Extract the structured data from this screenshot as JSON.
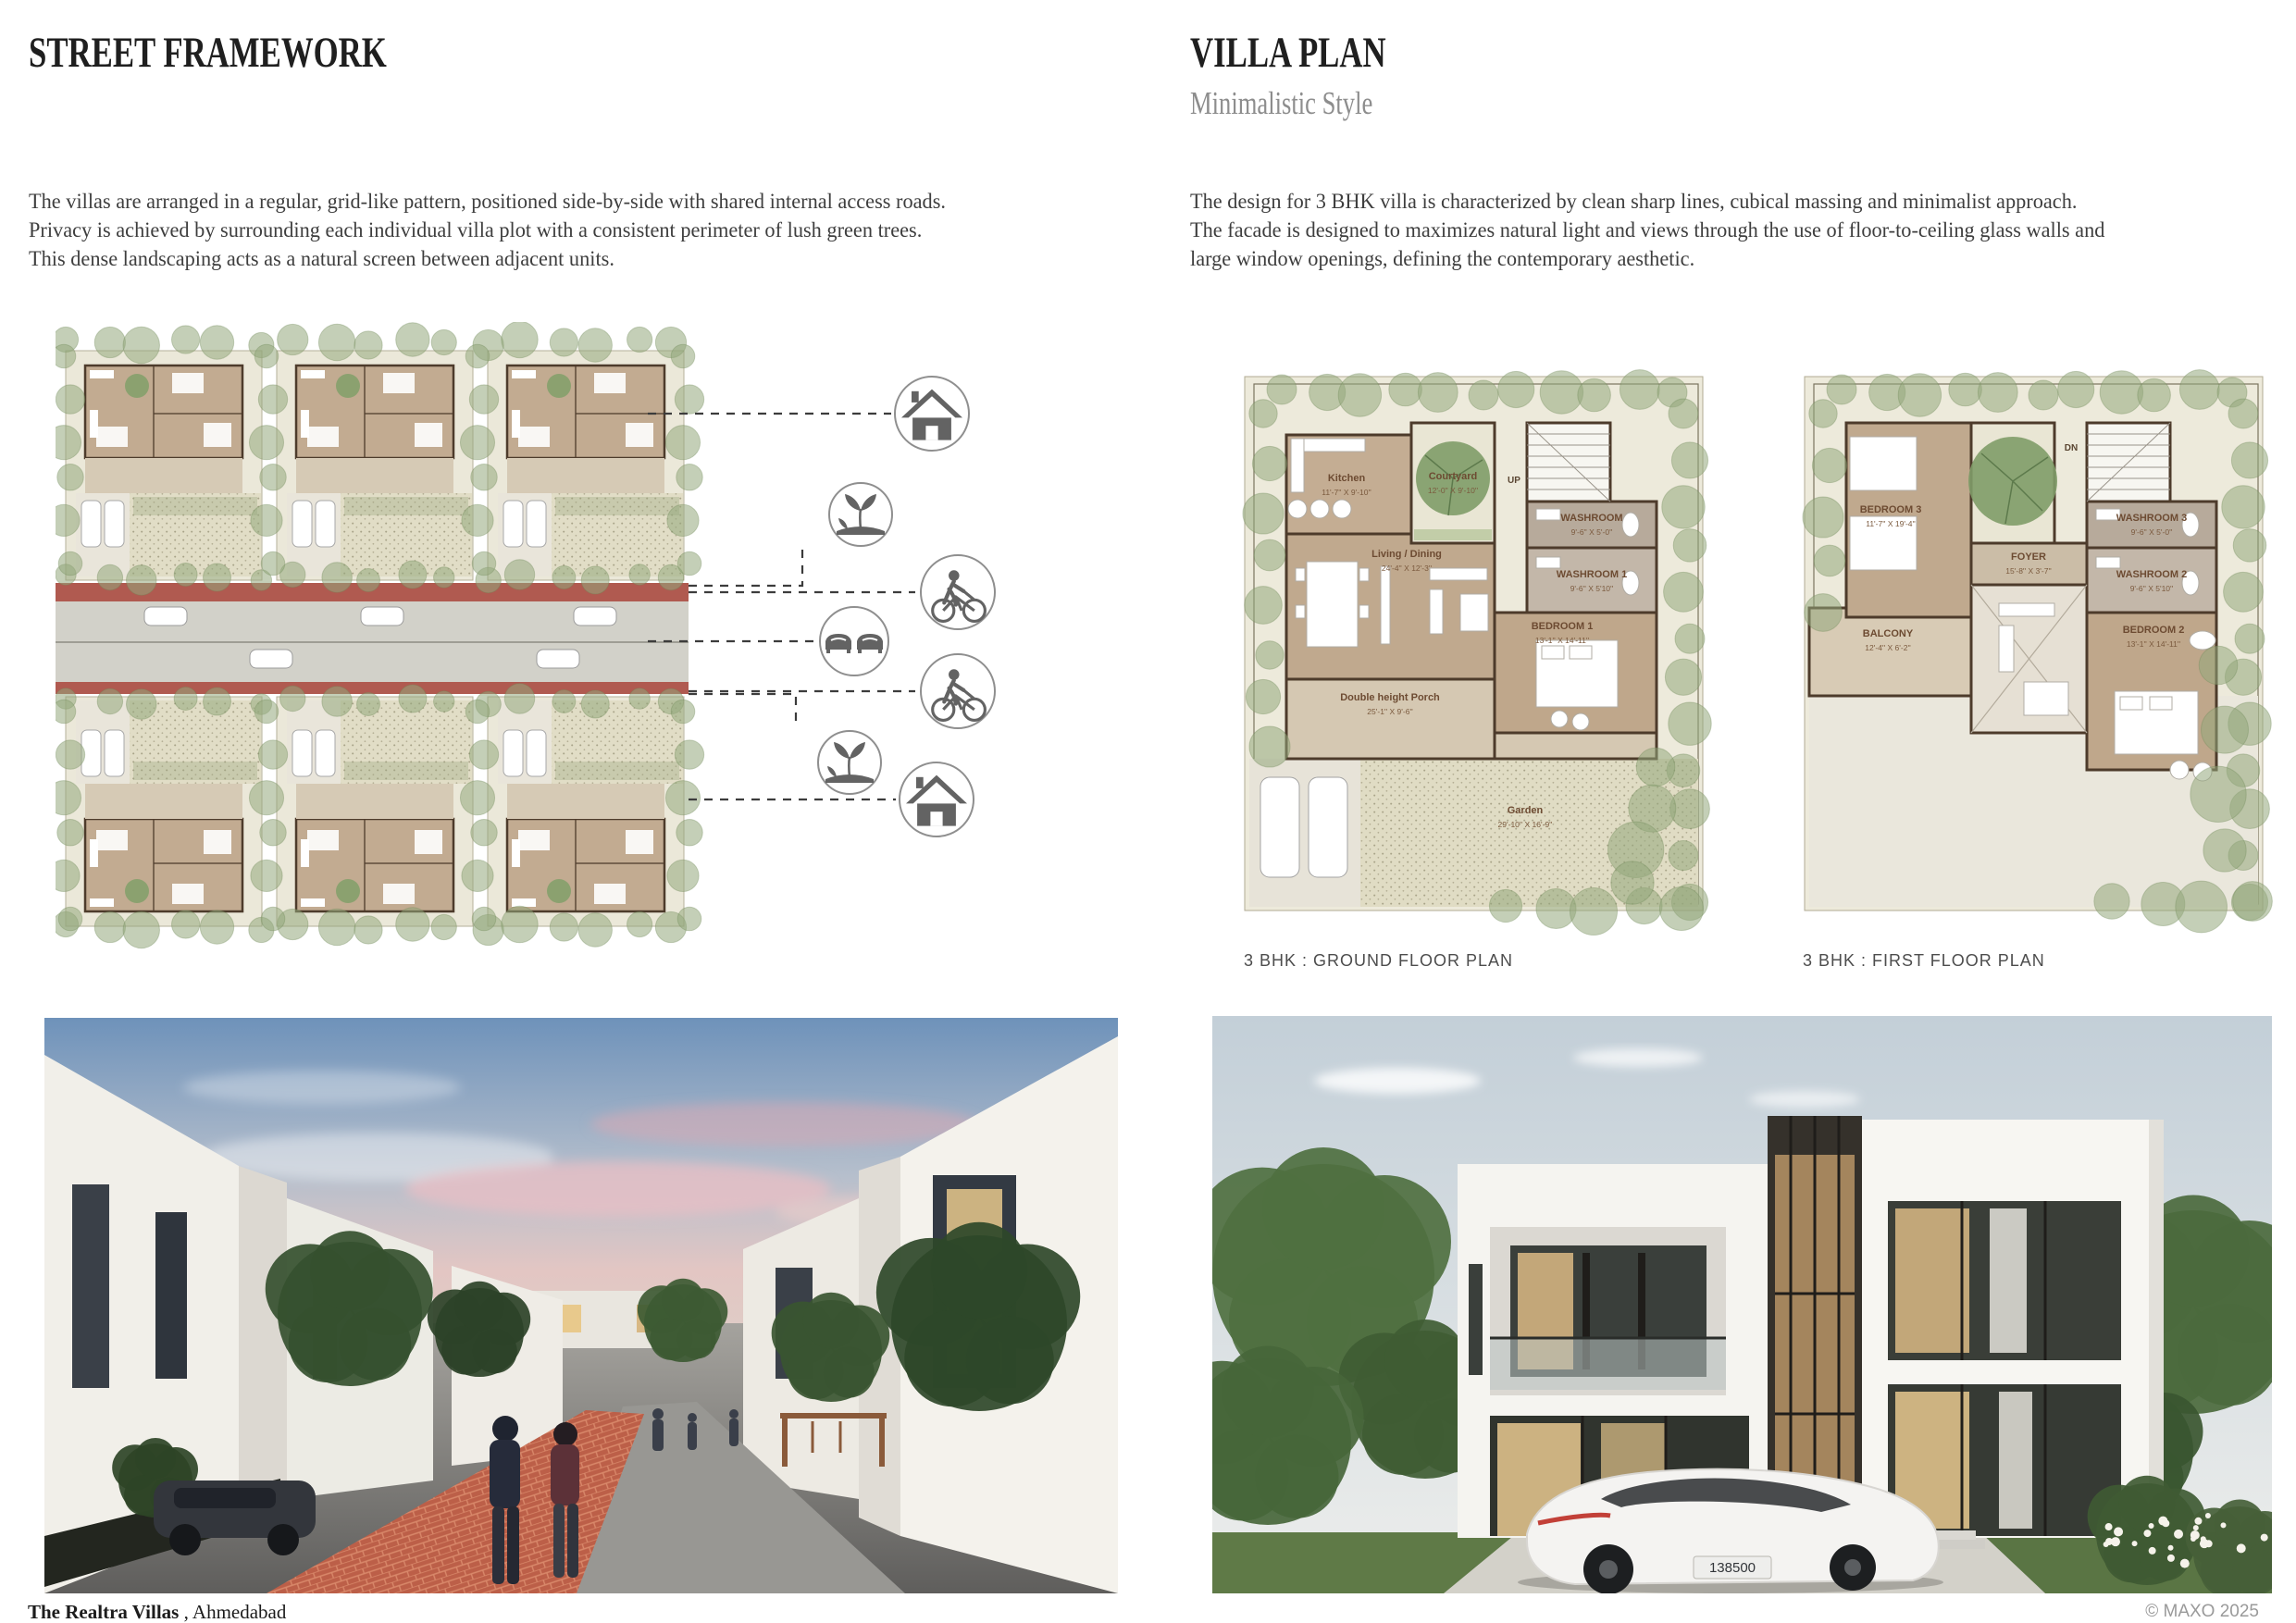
{
  "left": {
    "title": "STREET FRAMEWORK",
    "paragraph_lines": [
      "The villas are arranged in a regular, grid-like pattern, positioned side-by-side with shared internal access roads.",
      "Privacy is achieved by surrounding each individual villa plot with a consistent perimeter of lush green trees.",
      "This dense landscaping acts as a natural screen between adjacent units."
    ],
    "legend_icons": [
      {
        "id": "villa-house-top",
        "type": "house"
      },
      {
        "id": "green-buffer-top",
        "type": "plant"
      },
      {
        "id": "cycle-walk-lane-top",
        "type": "pedestrian-bicycle"
      },
      {
        "id": "two-way-road",
        "type": "cars"
      },
      {
        "id": "cycle-walk-lane-bottom",
        "type": "pedestrian-bicycle"
      },
      {
        "id": "green-buffer-bottom",
        "type": "plant"
      },
      {
        "id": "villa-house-bottom",
        "type": "house"
      }
    ]
  },
  "right": {
    "title": "VILLA PLAN",
    "subtitle": "Minimalistic Style",
    "paragraph_lines": [
      "The design for 3 BHK villa is characterized by clean sharp lines, cubical massing and minimalist approach.",
      "The facade is designed to maximizes natural light and views through the use of floor-to-ceiling glass walls and",
      "large window openings, defining the contemporary aesthetic."
    ],
    "ground_plan": {
      "caption": "3 BHK : GROUND FLOOR PLAN",
      "stair_label": "UP",
      "rooms": [
        {
          "name": "Kitchen",
          "dims": "11'-7'' X 9'-10''"
        },
        {
          "name": "Courtyard",
          "dims": "12'-0'' X 9'-10''"
        },
        {
          "name": "WASHROOM",
          "dims": "9'-6'' X 5'-0''"
        },
        {
          "name": "WASHROOM 1",
          "dims": "9'-6'' X 5'10''"
        },
        {
          "name": "Living / Dining",
          "dims": "24'-4'' X 12'-3''"
        },
        {
          "name": "BEDROOM 1",
          "dims": "13'-1'' X 14'-11''"
        },
        {
          "name": "Double height Porch",
          "dims": "25'-1'' X 9'-6''"
        },
        {
          "name": "Garden",
          "dims": "29'-10'' X 16'-9''"
        }
      ]
    },
    "first_plan": {
      "caption": "3 BHK : FIRST FLOOR PLAN",
      "stair_label": "DN",
      "rooms": [
        {
          "name": "BEDROOM 3",
          "dims": "11'-7'' X 19'-4''"
        },
        {
          "name": "FOYER",
          "dims": "15'-8'' X 3'-7''"
        },
        {
          "name": "WASHROOM 3",
          "dims": "9'-6'' X 5'-0''"
        },
        {
          "name": "WASHROOM 2",
          "dims": "9'-6'' X 5'10''"
        },
        {
          "name": "BALCONY",
          "dims": "12'-4'' X 6'-2''"
        },
        {
          "name": "BEDROOM 2",
          "dims": "13'-1'' X 14'-11''"
        }
      ]
    },
    "villa_photo": {
      "license_plate": "138500"
    }
  },
  "footer": {
    "project_bold": "The Realtra Villas",
    "project_rest": " , Ahmedabad",
    "credit": "© MAXO 2025"
  },
  "colors": {
    "road_red": "#b05a50",
    "road_grey": "#d2d1c9",
    "tree_green": "#93a87c",
    "wall_brown": "#4d3b2b",
    "floor_tan": "#c2ab91"
  }
}
